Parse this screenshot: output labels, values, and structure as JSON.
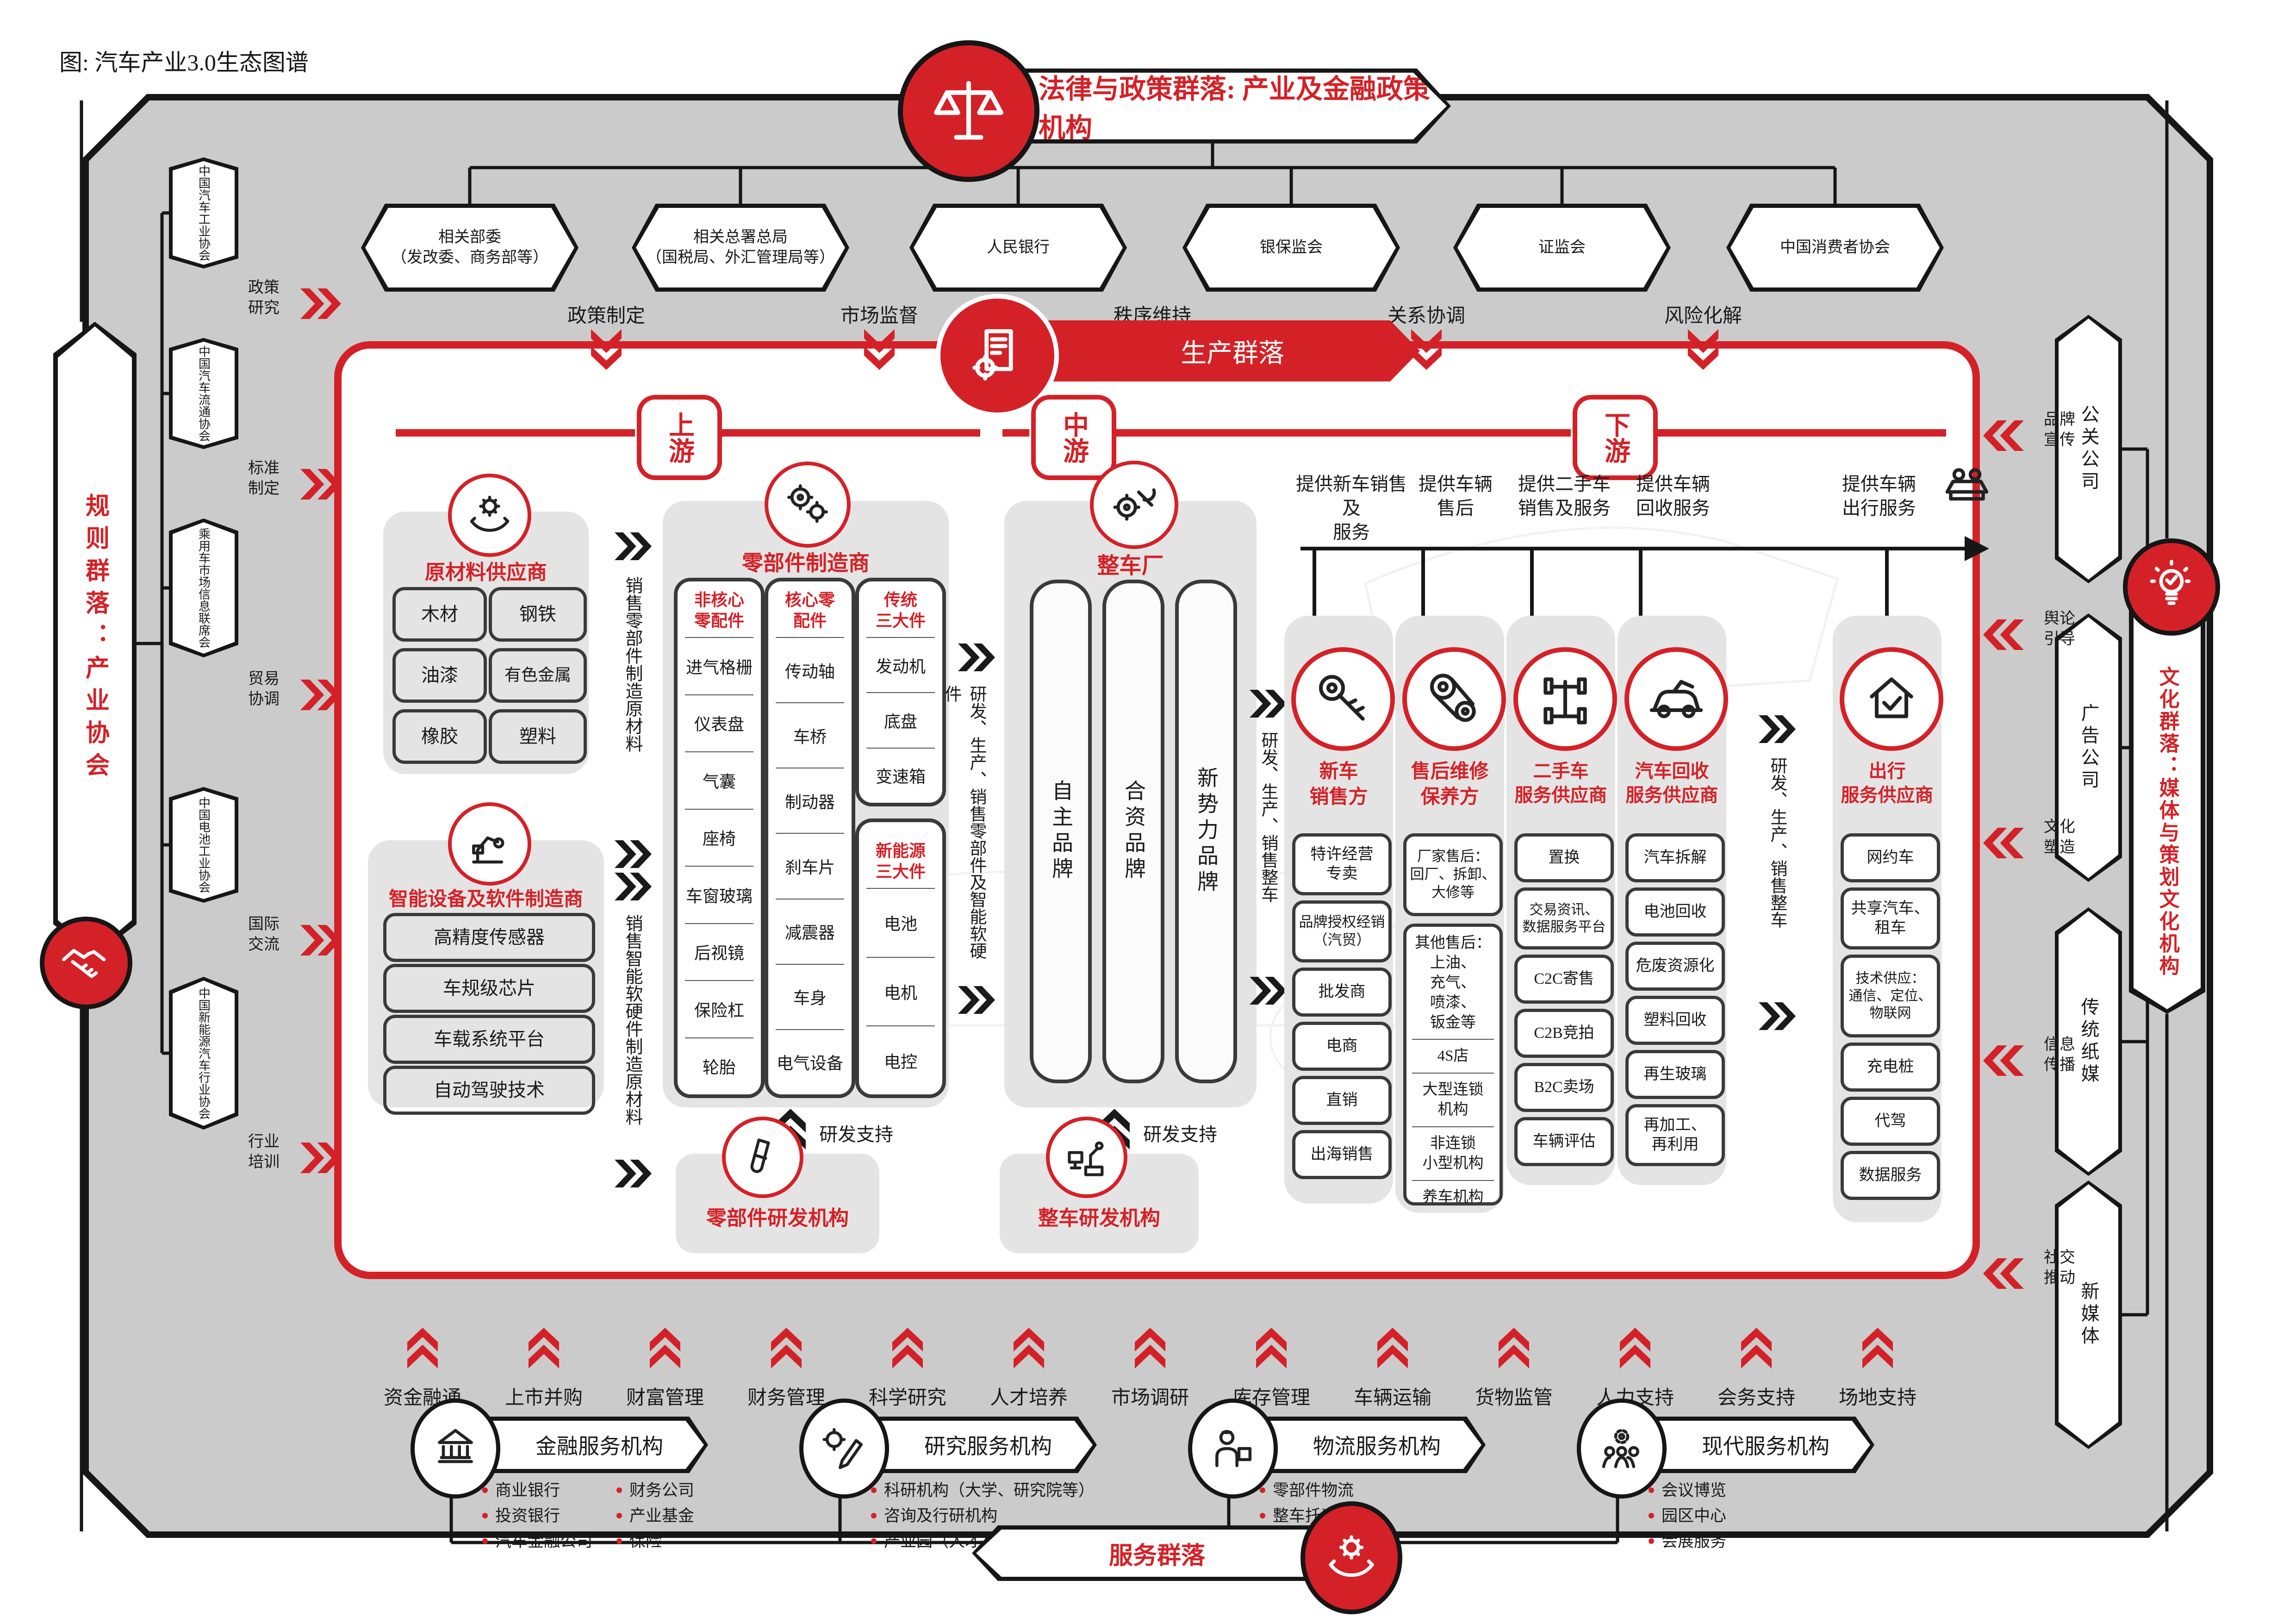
{
  "meta": {
    "caption": "图: 汽车产业3.0生态图谱"
  },
  "colors": {
    "accent": "#d42127",
    "canvas_gray": "#cbcbcb",
    "panel_gray": "#e4e4e4"
  },
  "top": {
    "banner": "法律与政策群落: 产业及金融政策机构",
    "orgs": [
      "相关部委\n（发改委、商务部等）",
      "相关总署总局\n（国税局、外汇管理局等）",
      "人民银行",
      "银保监会",
      "证监会",
      "中国消费者协会"
    ],
    "functions": [
      "政策制定",
      "市场监督",
      "秩序维持",
      "关系协调",
      "风险化解"
    ]
  },
  "left": {
    "cluster": "规则群落：产业协会",
    "orgs": [
      "中国汽车工业协会",
      "中国汽车流通协会",
      "乘用车市场信息联席会",
      "中国电池工业协会",
      "中国新能源汽车行业协会"
    ],
    "functions": [
      "政策\n研究",
      "标准\n制定",
      "贸易\n协调",
      "国际\n交流",
      "行业\n培训"
    ]
  },
  "right": {
    "cluster": "文化群落：媒体与策划文化机构",
    "orgs": [
      "公关公司",
      "广告公司",
      "传统纸媒",
      "新媒体"
    ],
    "functions": [
      "品牌\n宣传",
      "舆论\n引导",
      "文化\n塑造",
      "信息\n传播",
      "社交\n推动"
    ]
  },
  "production": {
    "banner": "生产群落",
    "streams": [
      "上游",
      "中游",
      "下游"
    ],
    "raw": {
      "title": "原材料供应商",
      "items": [
        "木材",
        "钢铁",
        "油漆",
        "有色金属",
        "橡胶",
        "塑料"
      ]
    },
    "flowA": "销售零部件制造原材料",
    "smart": {
      "title": "智能设备及软件制造商",
      "items": [
        "高精度传感器",
        "车规级芯片",
        "车载系统平台",
        "自动驾驶技术"
      ]
    },
    "flowB": "销售智能软硬件制造原材料",
    "parts": {
      "title": "零部件制造商",
      "cols": [
        {
          "header": "非核心\n零配件",
          "items": [
            "进气格栅",
            "仪表盘",
            "气囊",
            "座椅",
            "车窗玻璃",
            "后视镜",
            "保险杠",
            "轮胎"
          ]
        },
        {
          "header": "核心零\n配件",
          "items": [
            "传动轴",
            "车桥",
            "制动器",
            "刹车片",
            "减震器",
            "车身",
            "电气设备"
          ]
        },
        {
          "header": "传统\n三大件",
          "items": [
            "发动机",
            "底盘",
            "变速箱"
          ]
        },
        {
          "header": "新能源\n三大件",
          "items": [
            "电池",
            "电机",
            "电控"
          ]
        }
      ]
    },
    "flowMid": "研发、生产、销售零部件及智能软硬件",
    "oem": {
      "title": "整车厂",
      "brands": [
        "自主品牌",
        "合资品牌",
        "新势力品牌"
      ]
    },
    "flowDown": "研发、生产、销售整车",
    "rdSupport": "研发支持",
    "partsRD": "零部件研发机构",
    "vehicleRD": "整车研发机构",
    "downstream": {
      "labels": [
        "提供新车销售及\n服务",
        "提供车辆\n售后",
        "提供二手车\n销售及服务",
        "提供车辆\n回收服务",
        "提供车辆\n出行服务"
      ],
      "cols": [
        {
          "title": "新车\n销售方",
          "items": [
            "特许经营\n专卖",
            "品牌授权经销\n（汽贸）",
            "批发商",
            "电商",
            "直销",
            "出海销售"
          ]
        },
        {
          "title": "售后维修\n保养方",
          "factory": "厂家售后：\n回厂、拆卸、\n大修等",
          "others": [
            "其他售后：\n上油、\n充气、\n喷漆、\n钣金等",
            "4S店",
            "大型连锁\n机构",
            "非连锁\n小型机构",
            "养车机构"
          ]
        },
        {
          "title": "二手车\n服务供应商",
          "items": [
            "置换",
            "交易资讯、\n数据服务平台",
            "C2C寄售",
            "C2B竞拍",
            "B2C卖场",
            "车辆评估"
          ]
        },
        {
          "title": "汽车回收\n服务供应商",
          "items": [
            "汽车拆解",
            "电池回收",
            "危废资源化",
            "塑料回收",
            "再生玻璃",
            "再加工、\n再利用"
          ]
        },
        {
          "title": "出行\n服务供应商",
          "items": [
            "网约车",
            "共享汽车、\n租车",
            "技术供应：\n通信、定位、\n物联网",
            "充电桩",
            "代驾",
            "数据服务"
          ]
        }
      ]
    }
  },
  "bottom": {
    "functions": [
      "资金融通",
      "上市并购",
      "财富管理",
      "财务管理",
      "科学研究",
      "人才培养",
      "市场调研",
      "库存管理",
      "车辆运输",
      "货物监管",
      "人力支持",
      "会务支持",
      "场地支持"
    ],
    "groups": [
      {
        "title": "金融服务机构",
        "col1": [
          "商业银行",
          "投资银行",
          "汽车金融公司"
        ],
        "col2": [
          "财务公司",
          "产业基金",
          "保险"
        ]
      },
      {
        "title": "研究服务机构",
        "bullets": [
          "科研机构（大学、研究院等）",
          "咨询及行研机构",
          "产业园（人才基地、科创园等）"
        ]
      },
      {
        "title": "物流服务机构",
        "bullets": [
          "零部件物流",
          "整车托运",
          "货运仓储"
        ]
      },
      {
        "title": "现代服务机构",
        "bullets": [
          "会议博览",
          "园区中心",
          "会展服务"
        ]
      }
    ],
    "banner": "服务群落"
  }
}
